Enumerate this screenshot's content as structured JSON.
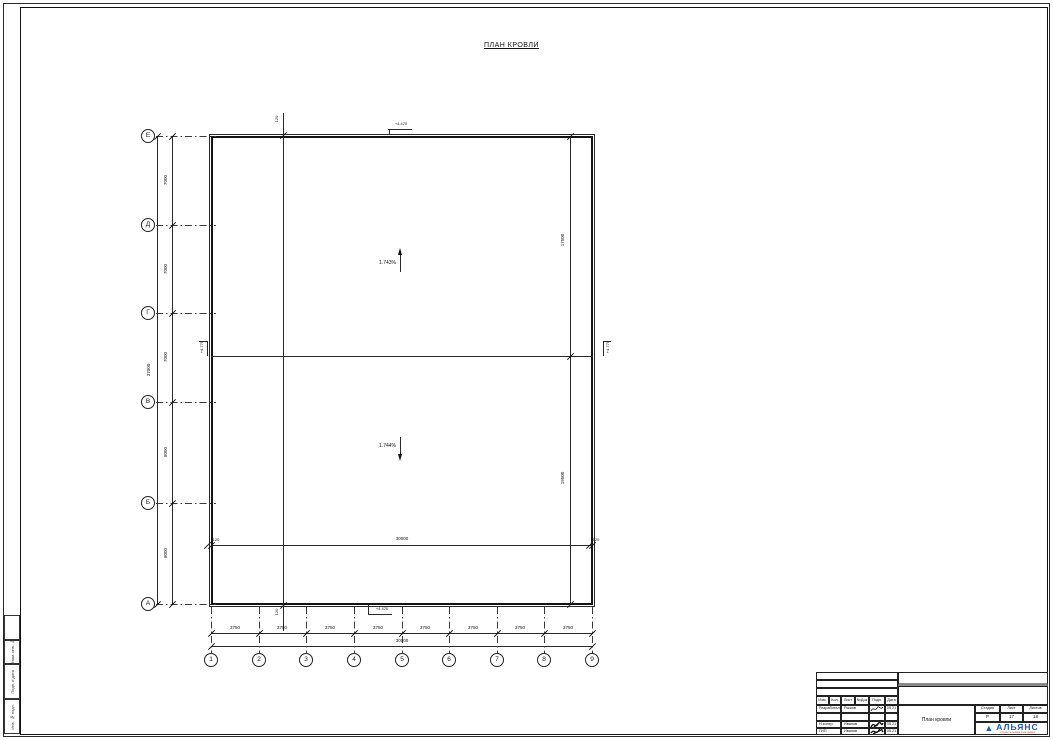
{
  "sheet": {
    "title": "ПЛАН КРОВЛИ"
  },
  "axes": {
    "left": [
      "Е",
      "Д",
      "Г",
      "В",
      "Б",
      "А"
    ],
    "bottom": [
      "1",
      "2",
      "3",
      "4",
      "5",
      "6",
      "7",
      "8",
      "9"
    ]
  },
  "dimensions": {
    "left_segments": [
      "7000",
      "7000",
      "7000",
      "8000",
      "8000"
    ],
    "left_total": "37000",
    "bottom_segments": [
      "3750",
      "3750",
      "3750",
      "3750",
      "3750",
      "3750",
      "3750",
      "3750"
    ],
    "bottom_total": "30000",
    "inner_total": "30000",
    "inner_offset_left": "120",
    "inner_offset_right": "120",
    "parapet_top": "120",
    "parapet_bottom": "120",
    "right_upper": "17500",
    "right_lower": "19500"
  },
  "slopes": {
    "upper": "1.743%",
    "lower": "1.744%"
  },
  "levels": {
    "top": "+4.470",
    "bottom": "+4.470",
    "ridge_left": "+4.775",
    "ridge_right": "+4.775"
  },
  "titleblock": {
    "header_cols": [
      "Изм.",
      "Кол.",
      "Лист",
      "№Док",
      "Подп.",
      "Дата"
    ],
    "rows": [
      {
        "role": "Разработал",
        "name": "Рыжов",
        "date": "05.21"
      },
      {
        "role": "Н.контр.",
        "name": "Иванов",
        "date": "05.21"
      },
      {
        "role": "ГИП",
        "name": "Иванов",
        "date": "05.21"
      }
    ],
    "stage_label": "Стадия",
    "sheet_label": "Лист",
    "sheets_label": "Листов",
    "stage": "Р",
    "sheet_no": "17",
    "sheets_total": "18",
    "doc_title": "План кровли",
    "logo": {
      "name": "АЛЬЯНС",
      "subtitle": "строительная компания",
      "accent": "#1a5fb4",
      "subtitle_color": "#c0392b"
    }
  },
  "frame_labels": {
    "c1": "Взам. инв. №",
    "c2": "Подп. и дата",
    "c3": "Инв. № подл."
  }
}
